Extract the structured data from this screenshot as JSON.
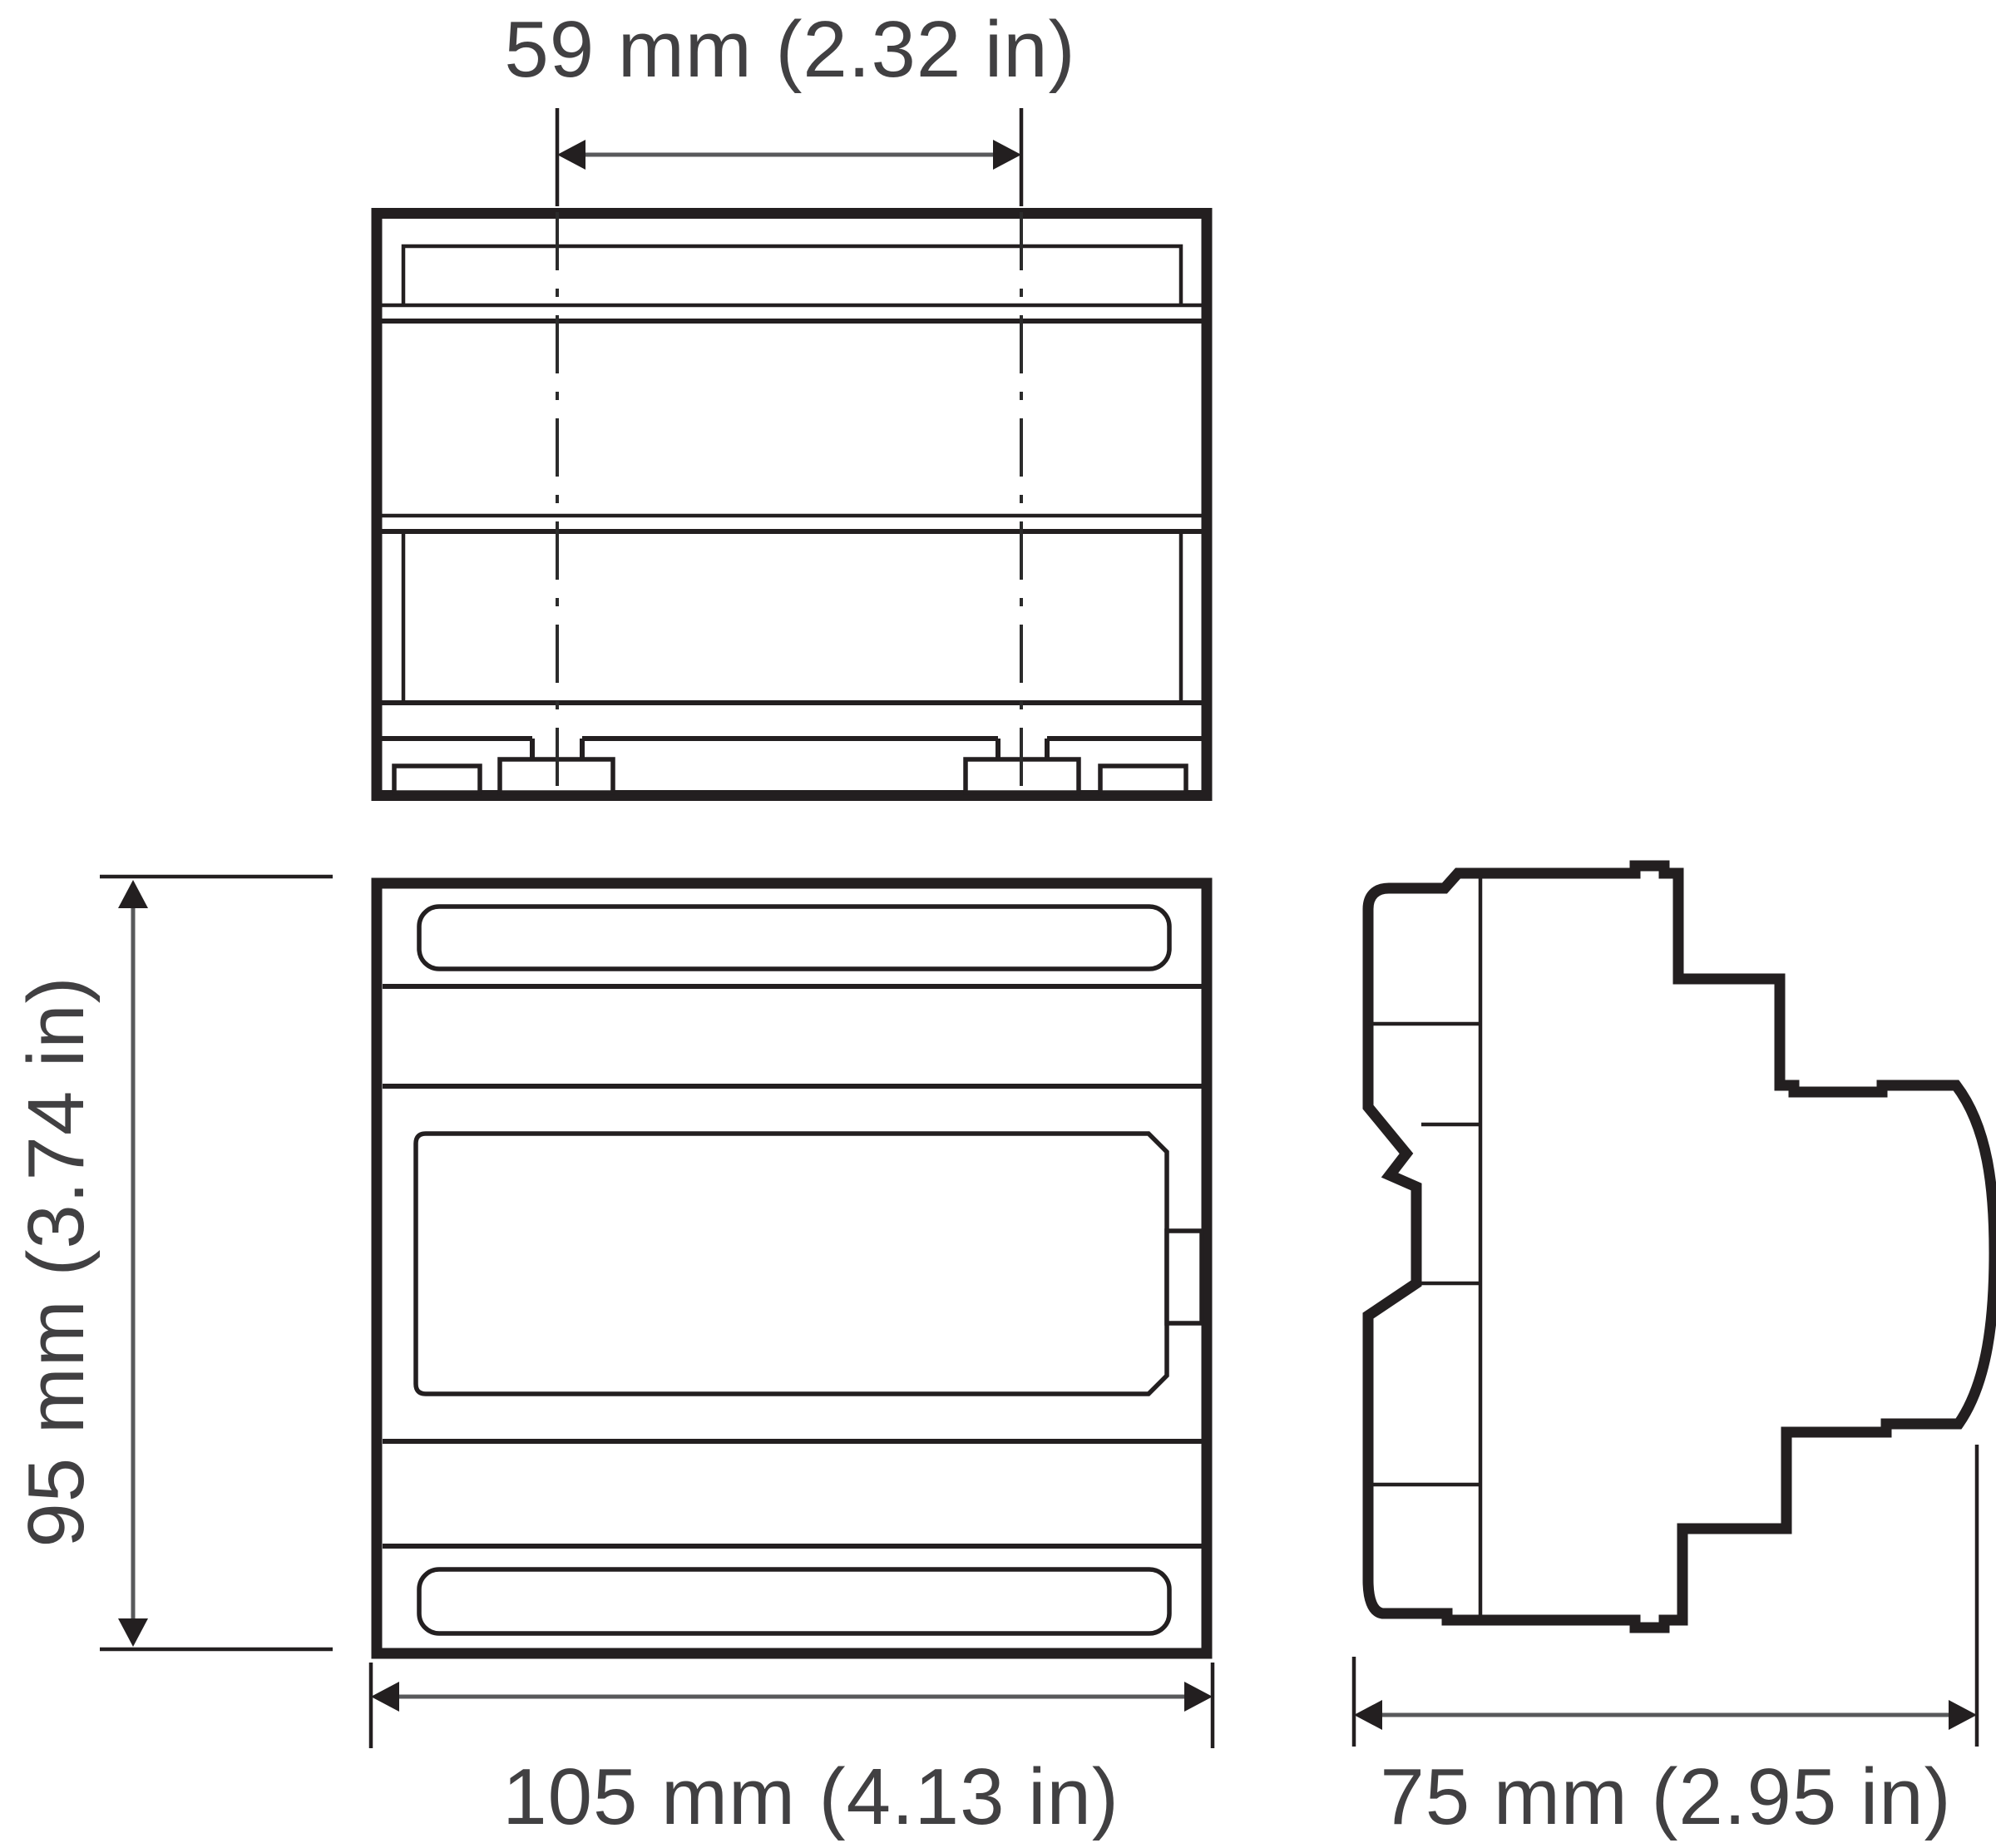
{
  "page": {
    "background": "#ffffff"
  },
  "drawing": {
    "type": "technical-dimension-diagram",
    "colors": {
      "line": "#231f20",
      "dimension_shaft": "#58595b",
      "text": "#414042"
    },
    "dimensions": {
      "mount_spacing": {
        "mm": 59,
        "inch": 2.32,
        "label": "59 mm (2.32 in)"
      },
      "height": {
        "mm": 95,
        "inch": 3.74,
        "label": "95 mm (3.74 in)"
      },
      "width": {
        "mm": 105,
        "inch": 4.13,
        "label": "105 mm (4.13 in)"
      },
      "depth": {
        "mm": 75,
        "inch": 2.95,
        "label": "75 mm (2.95 in)"
      }
    }
  }
}
